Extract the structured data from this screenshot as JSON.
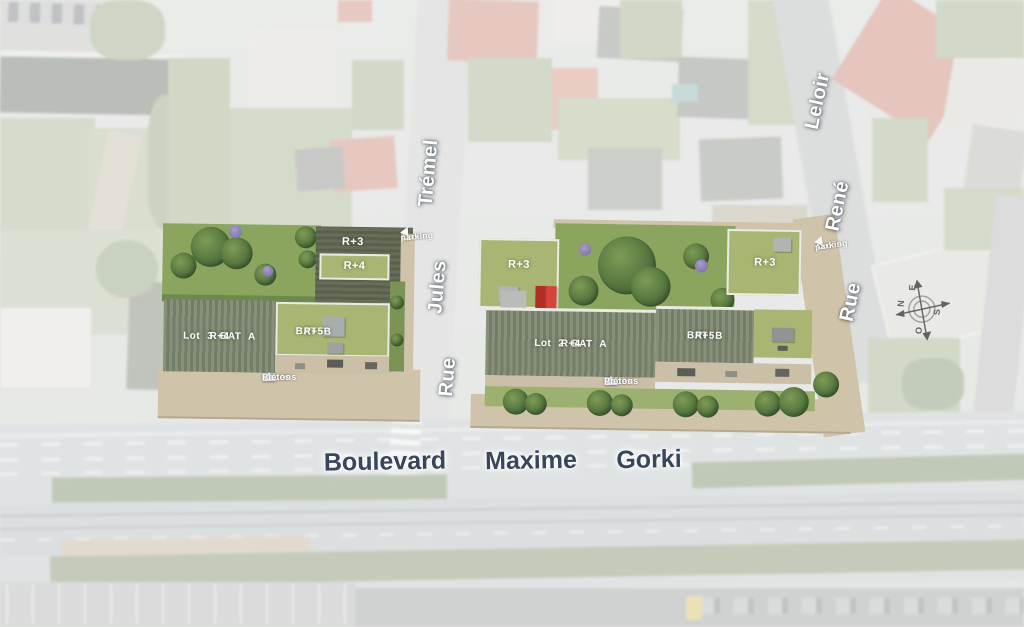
{
  "streets": {
    "rue_jules_tremel": {
      "parts": [
        "Rue",
        "Jules",
        "Trémel"
      ]
    },
    "rue_rene_leloir": {
      "parts": [
        "Rue",
        "René",
        "Leloir"
      ]
    },
    "boulevard_maxime_gorki": {
      "parts": [
        "Boulevard",
        "Maxime",
        "Gorki"
      ]
    }
  },
  "parcels": {
    "lot3": {
      "bat_a_label": "Lot 3   BAT A",
      "bat_a_level": "R+4",
      "bat_b_label": "BAT B",
      "bat_b_level": "R+5",
      "roof_back": "R+3",
      "roof_front": "R+4"
    },
    "lot2": {
      "bat_a_label": "Lot 2   BAT A",
      "bat_a_level": "R+4",
      "bat_b_label": "BAT B",
      "bat_b_level": "R+5",
      "roof_left": "R+3",
      "roof_right": "R+3"
    }
  },
  "access": {
    "parking_left": [
      "Accès",
      "parking"
    ],
    "parking_right": [
      "Accès",
      "parking"
    ],
    "pedestrian_left": [
      "Accès",
      "Piétons"
    ],
    "pedestrian_right": [
      "Accès",
      "Piétons"
    ]
  },
  "compass": {
    "n": "N",
    "e": "E",
    "s": "S",
    "o": "O"
  },
  "colors": {
    "lawn_roof": "#a8b573",
    "striped_roof": "#7d8670",
    "dark_roof": "#5f6754",
    "garden": "#8ba55f",
    "sidewalk": "#cfc3aa",
    "red_roof": "#c8352b",
    "boulevard_label_text": "#37465a"
  }
}
